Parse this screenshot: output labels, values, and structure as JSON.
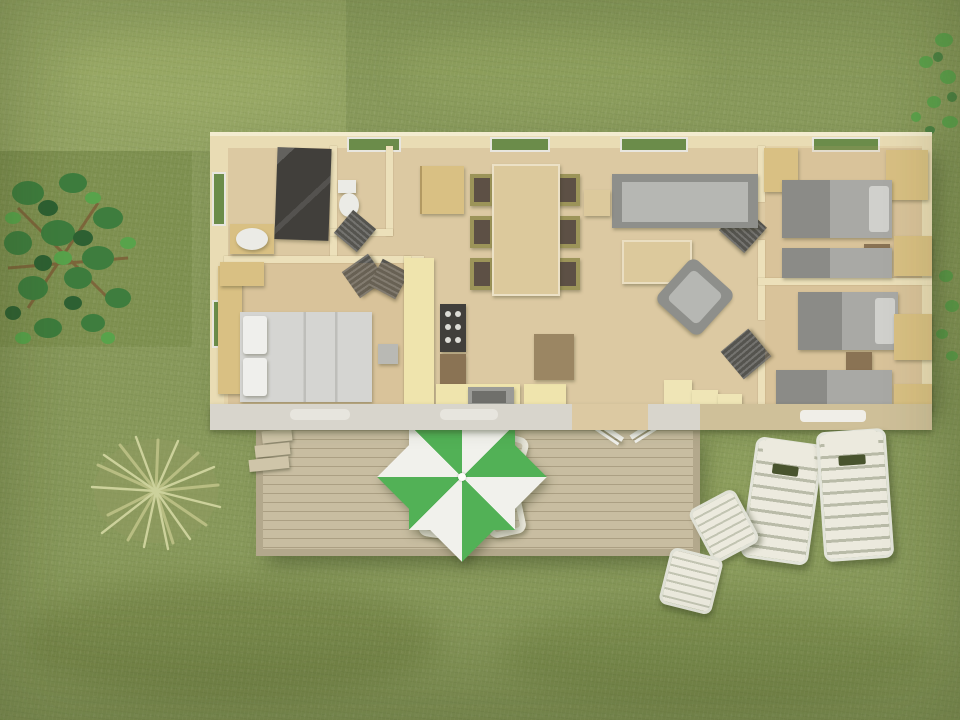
{
  "scene": {
    "view": "top-down-aerial-3d-render",
    "subject": "mobile-home-with-terrace-on-lawn"
  },
  "house": {
    "rooms": [
      {
        "name": "bathroom",
        "furniture": [
          "shower-cabin",
          "washbasin"
        ]
      },
      {
        "name": "wc",
        "furniture": [
          "toilet"
        ]
      },
      {
        "name": "master-bedroom",
        "furniture": [
          "double-bed",
          "wardrobe",
          "dresser",
          "side-table"
        ]
      },
      {
        "name": "kitchen",
        "furniture": [
          "counter",
          "stove",
          "oven",
          "sink",
          "island",
          "bar-unit"
        ]
      },
      {
        "name": "dining-area",
        "furniture": [
          "dining-table"
        ],
        "chair_count": 6
      },
      {
        "name": "living-room",
        "furniture": [
          "sofa",
          "coffee-table",
          "armchair",
          "side-table",
          "shelf-unit"
        ]
      },
      {
        "name": "bedroom-2",
        "furniture": [
          "single-bed",
          "single-bed",
          "nightstand",
          "wardrobe"
        ]
      },
      {
        "name": "bedroom-3",
        "furniture": [
          "single-bed",
          "single-bed",
          "nightstand",
          "wardrobe"
        ]
      }
    ],
    "window_count": 7,
    "open_door_count": 5
  },
  "outdoor": {
    "deck": {
      "steps": 3,
      "railings": 2
    },
    "parasol_set": {
      "parasol_colors": [
        "green",
        "white"
      ],
      "chair_count": 4
    },
    "sun_lounger_count": 2,
    "garden_chair_count": 2,
    "vegetation": [
      "tree",
      "ornamental-grass-bush",
      "shrub-sprigs"
    ]
  },
  "colors": {
    "grass_base": "#87985a",
    "grass_pale": "#93a363",
    "grass_deep": "#7b8e4e",
    "deck_wood": "#c8bda1",
    "deck_gap": "#ab9f83",
    "deck_edge": "#b3a88c",
    "step_wood": "#cfc5a9",
    "house_wall": "#e9dcb4",
    "house_wall_light": "#f3ecd0",
    "wall_inner": "#ece0ba",
    "wall_yellow": "#efe5b6",
    "floor_wood": "#dcc9a2",
    "counter_yellow": "#efe4ad",
    "wood_furniture": "#d9c083",
    "wood_dark": "#8a7354",
    "bar_wood": "#9b8663",
    "table_wood": "#dcc99c",
    "chair_frame": "#9c9459",
    "chair_seat": "#5d5045",
    "sofa_gray": "#8e8f8b",
    "sofa_seat": "#b6b7b3",
    "gray_dark": "#55544f",
    "shower_dark": "#413f3b",
    "white_soft": "#ebebe6",
    "white_plastic": "#eceade",
    "window_glass": "#6b8c4a",
    "window_frame": "#e8e6df",
    "parasol_green": "#52b156",
    "parasol_white": "#f1f1ec",
    "wall_band": "#d8d5cc",
    "wall_band_beige": "#cfc099",
    "vent_light": "#e7e5de",
    "bed_duvet": "#d5d5d2",
    "tree_green": "#3e7d3e",
    "tree_green_dark": "#2e6133",
    "tree_green_light": "#58a34b",
    "branch_brown": "#7c5c36",
    "bush_pale": "#ccd19b",
    "bush_mid": "#b8bd82",
    "bush_dark": "#8f9a60"
  }
}
